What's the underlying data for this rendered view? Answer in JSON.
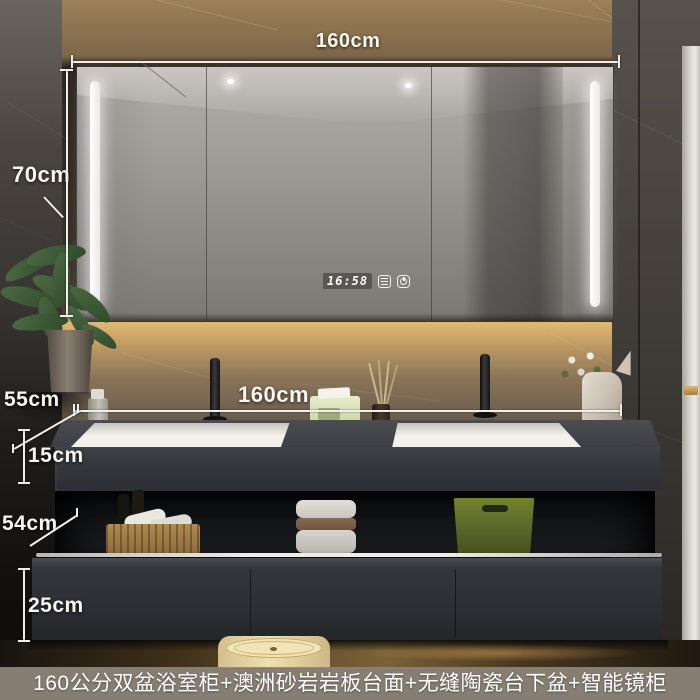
{
  "product_caption": "160公分双盆浴室柜+澳洲砂岩岩板台面+无缝陶瓷台下盆+智能镜柜",
  "annotations": {
    "mirror_width": "160cm",
    "mirror_height": "70cm",
    "counter_width": "160cm",
    "counter_depth": "55cm",
    "counter_apron_height": "15cm",
    "shelf_section_height": "54cm",
    "drawer_section_height": "25cm"
  },
  "mirror_display": {
    "time": "16:58",
    "buttons": [
      {
        "icon": "defog-icon"
      },
      {
        "icon": "power-icon"
      }
    ]
  },
  "colors": {
    "annotation_text": "#f7f5f0",
    "caption_background": "#8d8578",
    "caption_text": "#ffffff",
    "wall_warm_marble": "#8a7353",
    "dark_marble": "#3e3a36",
    "cabinet_dark": "#2e3134",
    "counter_stone": "#3a3d41",
    "sink_white": "#f2f1ec",
    "led_light": "#ffffff",
    "basket_green": "#66732c",
    "towel_stripe_brown": "#7a5c42",
    "trash_can_cream": "#e9d8a6",
    "door_frame_white": "#d9d6cf",
    "handle_gold": "#c09a4e"
  }
}
